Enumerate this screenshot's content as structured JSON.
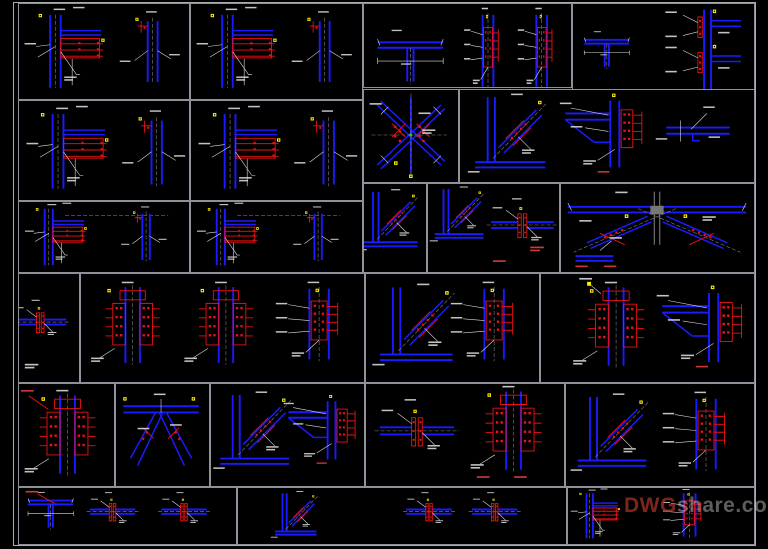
{
  "watermark": {
    "prefix": "DWG",
    "suffix": "share.com"
  },
  "colors": {
    "background": "#000000",
    "sheet_border": "#a9a9b0",
    "panel_border": "#90909a",
    "member_blue": "#1a1aff",
    "plate_red": "#ee1212",
    "marker_yellow": "#ffec00",
    "annotation_white": "#dcdcdc",
    "centerline_gray": "#8a8a8a",
    "accent_green": "#22cc22",
    "watermark_red": "#cc3a33",
    "watermark_gray": "#cfcfcf"
  }
}
